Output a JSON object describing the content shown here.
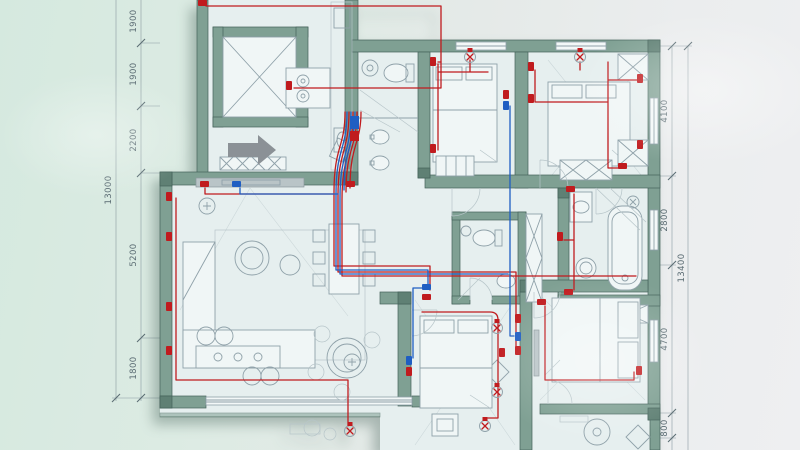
{
  "meta": {
    "kind": "apartment-electrical-wiring-floor-plan"
  },
  "dimensions": {
    "left": {
      "overall": "13000",
      "segments": [
        "1900",
        "1900",
        "2200",
        "5200",
        "1800"
      ]
    },
    "right": {
      "overall": "13400",
      "segments": [
        "4100",
        "2800",
        "4700",
        "800"
      ]
    }
  },
  "colors": {
    "wall_fill": "#7fa093",
    "wall_edge": "#44625a",
    "wall_dark": "#5f8074",
    "floor": "#e6efef",
    "room_tint": "#dfeaec",
    "bg_mint": "#d5e9df",
    "bg_gray": "#ebedee",
    "wire_red": "#c01b1e",
    "wire_blue": "#1f5ec2",
    "furniture": "#8fa1a9",
    "faint": "#b7c5c9",
    "dim_line": "#8a9aa1",
    "dim_text": "#5c6d74",
    "arrow": "#8b9196",
    "window": "#f3f8f8"
  },
  "icons": {
    "entry_arrow": "arrow-right",
    "power_outlet": "red-wall-socket",
    "low_voltage_outlet": "blue-wall-socket",
    "ceiling_light": "circle-cross"
  }
}
